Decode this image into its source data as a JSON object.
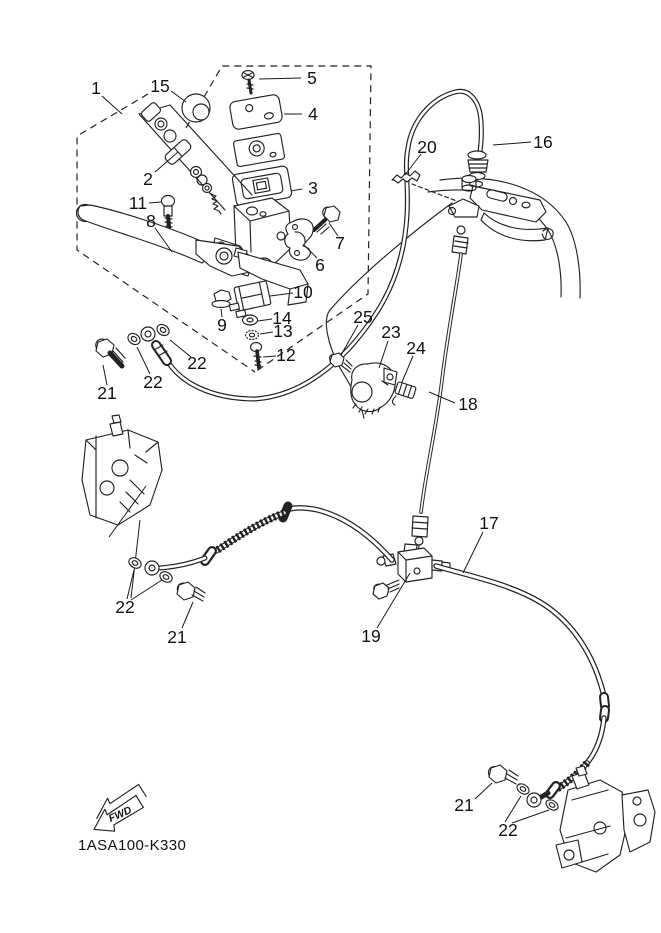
{
  "diagram": {
    "title": "front master cylinder exploded parts diagram",
    "part_code": "1ASA100-K330",
    "fwd_label": "FWD",
    "line_color": "#222222",
    "background": "#ffffff",
    "callouts": [
      {
        "label": "1",
        "x": 96,
        "y": 94
      },
      {
        "label": "15",
        "x": 160,
        "y": 92
      },
      {
        "label": "5",
        "x": 312,
        "y": 84
      },
      {
        "label": "4",
        "x": 313,
        "y": 120
      },
      {
        "label": "2",
        "x": 148,
        "y": 185
      },
      {
        "label": "3",
        "x": 313,
        "y": 194
      },
      {
        "label": "11",
        "x": 138,
        "y": 209
      },
      {
        "label": "8",
        "x": 151,
        "y": 227
      },
      {
        "label": "7",
        "x": 340,
        "y": 249
      },
      {
        "label": "6",
        "x": 320,
        "y": 271
      },
      {
        "label": "10",
        "x": 303,
        "y": 298
      },
      {
        "label": "14",
        "x": 282,
        "y": 324
      },
      {
        "label": "13",
        "x": 283,
        "y": 337
      },
      {
        "label": "9",
        "x": 222,
        "y": 331
      },
      {
        "label": "12",
        "x": 286,
        "y": 361
      },
      {
        "label": "22",
        "x": 197,
        "y": 369
      },
      {
        "label": "22",
        "x": 153,
        "y": 388
      },
      {
        "label": "21",
        "x": 107,
        "y": 399
      },
      {
        "label": "25",
        "x": 363,
        "y": 323
      },
      {
        "label": "23",
        "x": 391,
        "y": 338
      },
      {
        "label": "24",
        "x": 416,
        "y": 354
      },
      {
        "label": "18",
        "x": 468,
        "y": 410
      },
      {
        "label": "20",
        "x": 427,
        "y": 153
      },
      {
        "label": "16",
        "x": 543,
        "y": 148
      },
      {
        "label": "17",
        "x": 489,
        "y": 529
      },
      {
        "label": "19",
        "x": 371,
        "y": 642
      },
      {
        "label": "22",
        "x": 125,
        "y": 613
      },
      {
        "label": "21",
        "x": 177,
        "y": 643
      },
      {
        "label": "21",
        "x": 464,
        "y": 811
      },
      {
        "label": "22",
        "x": 508,
        "y": 836
      }
    ]
  }
}
